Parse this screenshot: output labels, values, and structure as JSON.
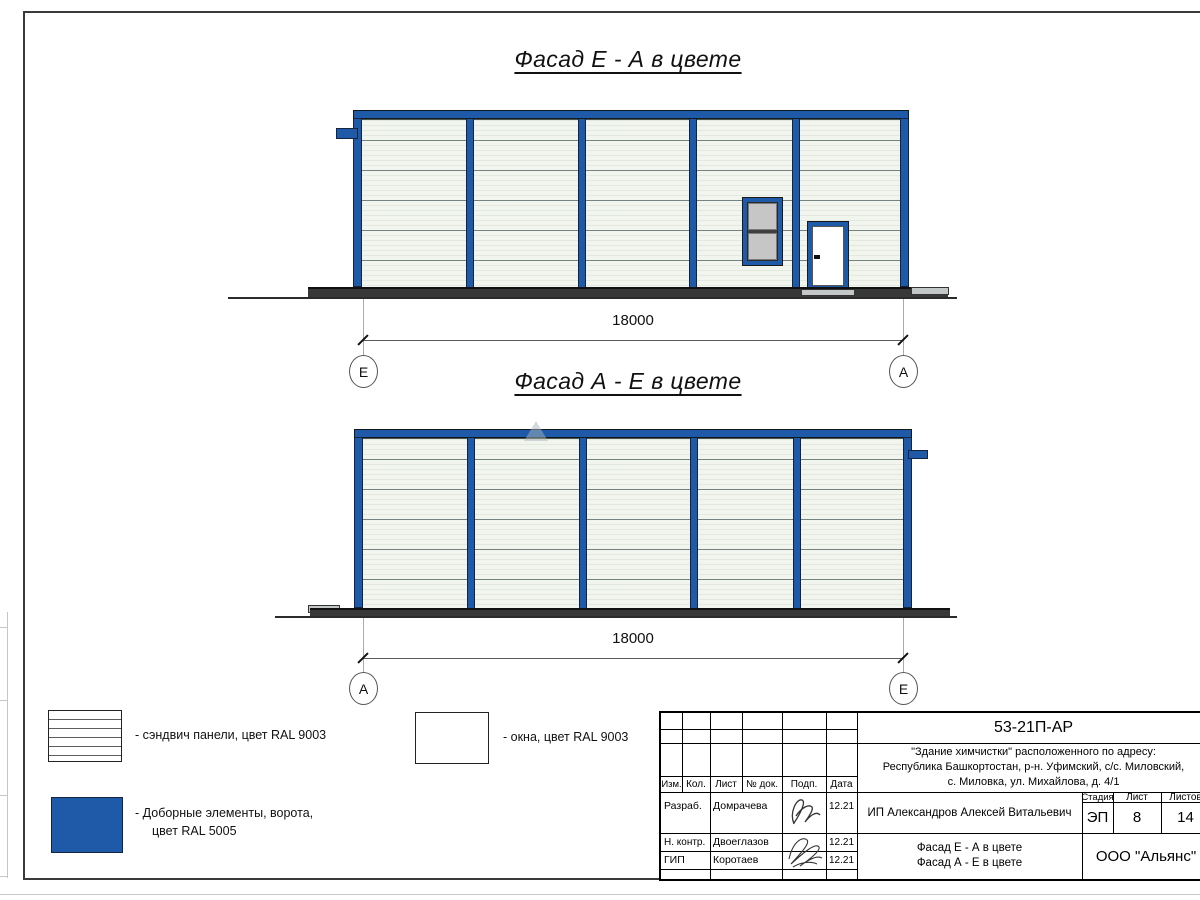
{
  "facade1": {
    "title": "Фасад Е - А в цвете",
    "dim": "18000",
    "axis_left": "Е",
    "axis_right": "А"
  },
  "facade2": {
    "title": "Фасад А - Е в цвете",
    "dim": "18000",
    "axis_left": "А",
    "axis_right": "Е"
  },
  "legend": {
    "panels": "- сэндвич панели, цвет RAL 9003",
    "windows": "- окна, цвет RAL 9003",
    "elements1": "- Доборные элементы, ворота,",
    "elements2": "цвет RAL 5005"
  },
  "colors": {
    "accent_blue": "#1E5AA8"
  },
  "title_block": {
    "doc_number": "53-21П-АР",
    "address1": "\"Здание химчистки\" расположенного по адресу:",
    "address2": "Республика Башкортостан, р-н. Уфимский, с/с. Миловский,",
    "address3": "с. Миловка, ул. Михайлова, д. 4/1",
    "col_izm": "Изм.",
    "col_kol": "Кол.",
    "col_list": "Лист",
    "col_ndok": "№ док.",
    "col_podp": "Подп.",
    "col_data": "Дата",
    "r1_role": "Разраб.",
    "r1_name": "Домрачева",
    "r1_date": "12.21",
    "r2_role": "Н. контр.",
    "r2_name": "Двоеглазов",
    "r2_date": "12.21",
    "r3_role": "ГИП",
    "r3_name": "Коротаев",
    "r3_date": "12.21",
    "client": "ИП Александров Алексей Витальевич",
    "stage_label": "Стадия",
    "list_label": "Лист",
    "listov_label": "Листов",
    "stage": "ЭП",
    "list": "8",
    "listov": "14",
    "name1": "Фасад Е - А в цвете",
    "name2": "Фасад А - Е в цвете",
    "company": "ООО \"Альянс\""
  }
}
